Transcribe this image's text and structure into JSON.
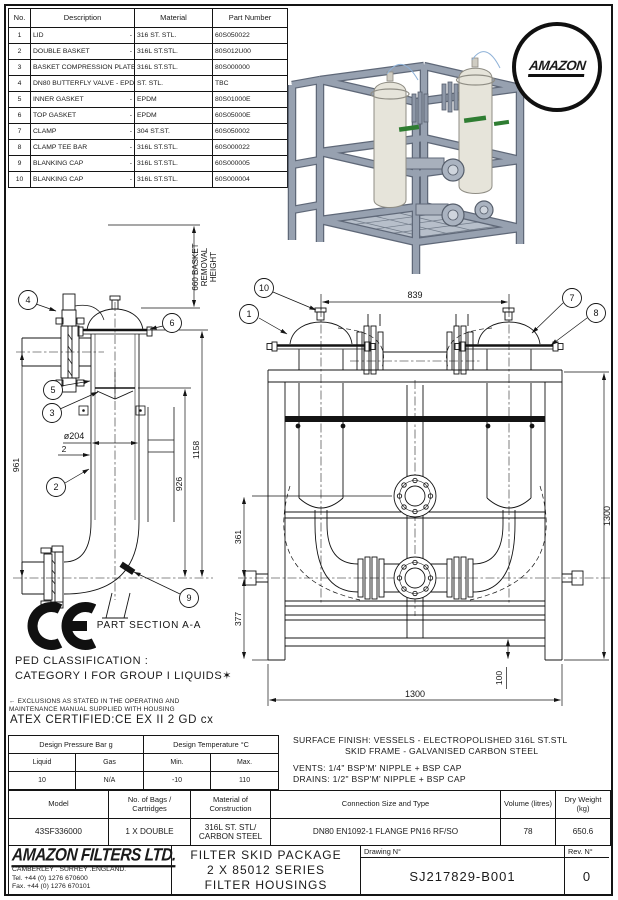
{
  "parts_table": {
    "col_no": "No.",
    "col_description": "Description",
    "col_material": "Material",
    "col_part": "Part Number",
    "separator": "-",
    "rows": [
      {
        "no": "1",
        "description": "LID",
        "material": "316 ST. STL.",
        "part_number": "60S050022"
      },
      {
        "no": "2",
        "description": "DOUBLE BASKET",
        "material": "316L ST.STL.",
        "part_number": "80S012U00"
      },
      {
        "no": "3",
        "description": "BASKET COMPRESSION PLATE",
        "material": "316L ST.STL.",
        "part_number": "80S000000"
      },
      {
        "no": "4",
        "description": "DN80 BUTTERFLY VALVE - EPDM",
        "material": "ST. STL.",
        "part_number": "TBC"
      },
      {
        "no": "5",
        "description": "INNER GASKET",
        "material": "EPDM",
        "part_number": "80S01000E"
      },
      {
        "no": "6",
        "description": "TOP GASKET",
        "material": "EPDM",
        "part_number": "60S05000E"
      },
      {
        "no": "7",
        "description": "CLAMP",
        "material": "304 ST.ST.",
        "part_number": "60S050002"
      },
      {
        "no": "8",
        "description": "CLAMP TEE BAR",
        "material": "316L ST.STL.",
        "part_number": "60S000022"
      },
      {
        "no": "9",
        "description": "BLANKING CAP",
        "material": "316L ST.STL.",
        "part_number": "60S000005"
      },
      {
        "no": "10",
        "description": "BLANKING CAP",
        "material": "316L ST.STL.",
        "part_number": "60S000004"
      }
    ]
  },
  "logo_badge": {
    "text": "AMAZON"
  },
  "marks": {
    "ce": "CE"
  },
  "left_drawing": {
    "section_label": "PART SECTION A-A",
    "b2": "2",
    "b3": "3",
    "b4": "4",
    "b5": "5",
    "b6": "6",
    "b9": "9",
    "dim_removal_1": "660 BASKET",
    "dim_removal_2": "REMOVAL",
    "dim_removal_3": "HEIGHT",
    "dim_961": "961",
    "dim_926": "926",
    "dim_1158": "1158",
    "dim_dia": "ø204",
    "dim_wall": "2"
  },
  "right_drawing": {
    "b1": "1",
    "b7": "7",
    "b8": "8",
    "b10": "10",
    "dim_839": "839",
    "dim_361": "361",
    "dim_377": "377",
    "dim_1300_h": "1300",
    "dim_1300_w": "1300",
    "dim_100": "100"
  },
  "notes": {
    "ped_1": "PED CLASSIFICATION :",
    "ped_2": "CATEGORY I FOR GROUP I LIQUIDS✶",
    "footnote_1": "← EXCLUSIONS AS STATED IN THE OPERATING AND",
    "footnote_2": "MAINTENANCE MANUAL SUPPLIED WITH HOUSING",
    "atex": "ATEX CERTIFIED:CE EX II 2 GD cx",
    "surface_1": "SURFACE FINISH: VESSELS - ELECTROPOLISHED 316L ST.STL",
    "surface_2": "SKID FRAME - GALVANISED CARBON STEEL",
    "vents": "VENTS: 1/4\" BSP'M' NIPPLE + BSP CAP",
    "drains": "DRAINS: 1/2\" BSP'M'  NIPPLE + BSP CAP"
  },
  "design_table": {
    "pressure_header": "Design Pressure Bar g",
    "temp_header": "Design Temperature °C",
    "col_liquid": "Liquid",
    "col_gas": "Gas",
    "col_min": "Min.",
    "col_max": "Max.",
    "val_liquid": "10",
    "val_gas": "N/A",
    "val_min": "-10",
    "val_max": "110"
  },
  "spec_table": {
    "col_model": "Model",
    "col_bags": "No. of Bags / Cartridges",
    "col_material": "Material of Construction",
    "col_connection": "Connection Size and Type",
    "col_volume": "Volume (litres)",
    "col_weight": "Dry Weight (kg)",
    "model": "43SF336000",
    "bags": "1 X DOUBLE",
    "material": "316L ST. STL/ CARBON STEEL",
    "connection": "DN80 EN1092-1 FLANGE PN16 RF/SO",
    "volume": "78",
    "weight": "650.6"
  },
  "title_block": {
    "company": "AMAZON FILTERS LTD.",
    "address": "CAMBERLEY . SURREY .ENGLAND.",
    "tel": "Tel. +44 (0) 1276 670600",
    "fax": "Fax. +44 (0) 1276 670101",
    "title_1": "FILTER SKID PACKAGE",
    "title_2": "2 X 85012 SERIES",
    "title_3": "FILTER HOUSINGS",
    "drawing_label": "Drawing N°",
    "drawing_no": "SJ217829-B001",
    "rev_label": "Rev. N°",
    "rev": "0"
  },
  "colors": {
    "line": "#1a1a1a",
    "steel": "#97a1b0",
    "steel_dark": "#5f6878",
    "vessel": "#e6e4da",
    "green": "#2f7d32"
  }
}
